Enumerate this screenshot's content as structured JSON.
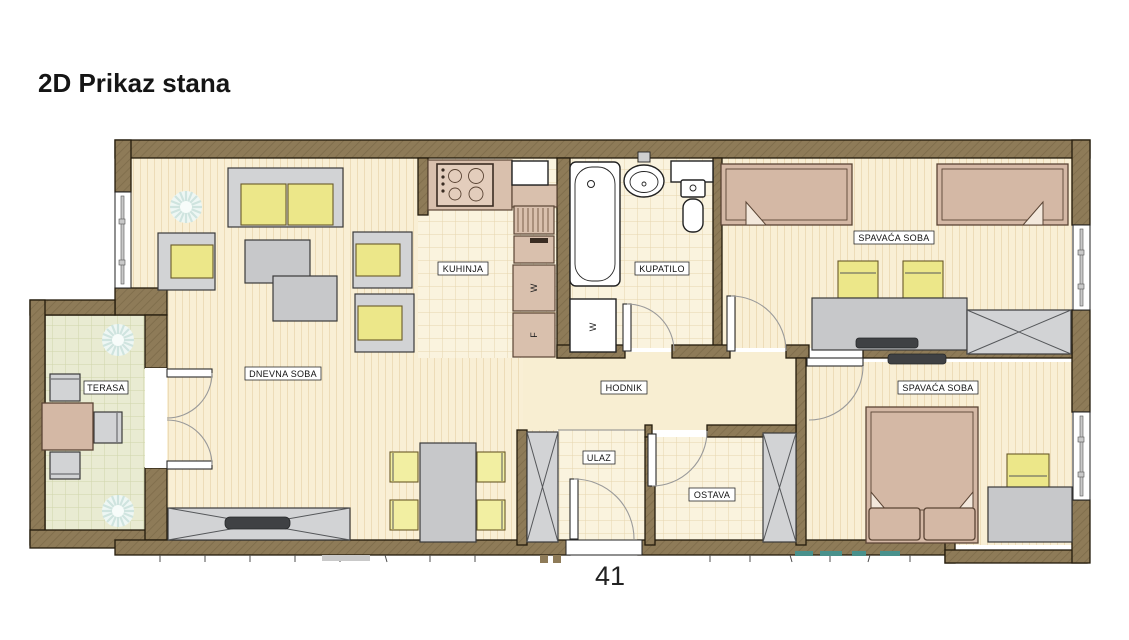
{
  "title": "2D Prikaz stana",
  "page_number": "41",
  "rooms": {
    "terasa": "TERASA",
    "dnevna_soba": "DNEVNA SOBA",
    "kuhinja": "KUHINJA",
    "kupatilo": "KUPATILO",
    "hodnik": "HODNIK",
    "ulaz": "ULAZ",
    "ostava": "OSTAVA",
    "spavaca_soba_1": "SPAVAĆA SOBA",
    "spavaca_soba_2": "SPAVAĆA SOBA"
  },
  "appliances": {
    "kitchen_washer_label": "W",
    "kitchen_fridge_label": "F",
    "bathroom_washer_label": "W"
  },
  "colors": {
    "wall": "#8e7b58",
    "floor_cream": "#f9efd5",
    "floor_tile": "#faf3de",
    "terrace_floor": "#e9ebd2",
    "furniture_gray": "#d2d3d5",
    "cushion_yellow": "#ece789",
    "wood_tan": "#d4b8a5",
    "screen_dark": "#3f4144",
    "watermark_teal": "#49918c"
  }
}
